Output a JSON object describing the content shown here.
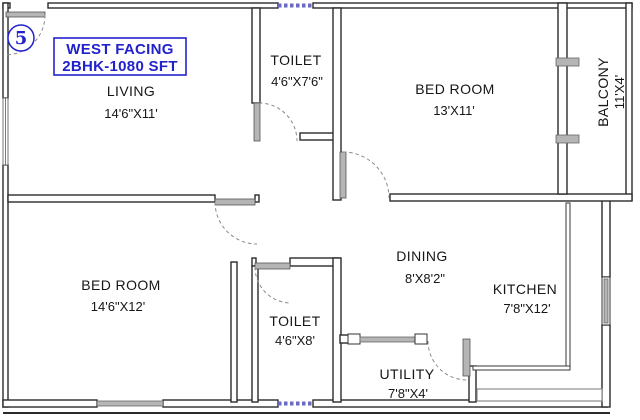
{
  "plan": {
    "unit_label": "5",
    "info_box": {
      "line1": "WEST FACING",
      "line2": "2BHK-1080 SFT"
    },
    "colors": {
      "accent_blue": "#2222cc",
      "wall_dark": "#2b2b2b",
      "hatch_gray": "#b5b5b5",
      "door_arc_gray": "#8a8a8a",
      "window_blue": "#6a6ac0"
    },
    "rooms": [
      {
        "name": "LIVING",
        "dims": "14'6\"X11'"
      },
      {
        "name": "TOILET",
        "dims": "4'6\"X7'6\""
      },
      {
        "name": "BED ROOM",
        "dims": "13'X11'"
      },
      {
        "name": "BALCONY",
        "dims": "11'X4'"
      },
      {
        "name": "BED ROOM",
        "dims": "14'6\"X12'"
      },
      {
        "name": "DINING",
        "dims": "8'X8'2\""
      },
      {
        "name": "KITCHEN",
        "dims": "7'8\"X12'"
      },
      {
        "name": "TOILET",
        "dims": "4'6\"X8'"
      },
      {
        "name": "UTILITY",
        "dims": "7'8\"X4'"
      }
    ]
  }
}
